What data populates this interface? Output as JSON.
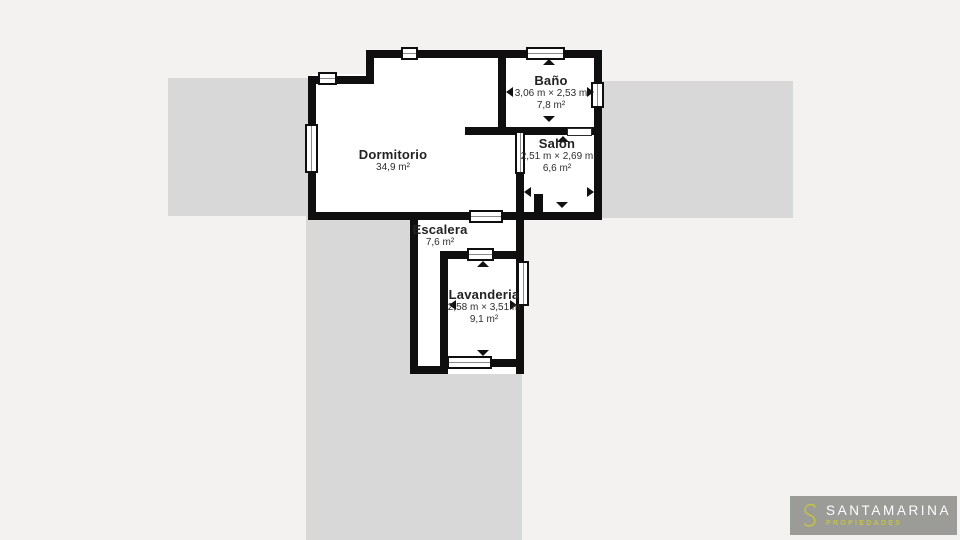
{
  "rooms": {
    "dormitorio": {
      "name": "Dormitorio",
      "area": "34,9 m²"
    },
    "bano": {
      "name": "Baño",
      "dims": "3,06 m × 2,53 m",
      "area": "7,8 m²"
    },
    "salon": {
      "name": "Salón",
      "dims": "2,51 m × 2,69 m",
      "area": "6,6 m²"
    },
    "escalera": {
      "name": "Escalera",
      "area": "7,6 m²"
    },
    "lavanderia": {
      "name": "Lavanderia",
      "dims": "2,58 m × 3,51 m",
      "area": "9,1 m²"
    }
  },
  "logo": {
    "monogram": "S",
    "brand": "SANTAMARINA",
    "tagline": "PROPIEDADES"
  },
  "colors": {
    "background": "#f3f2f0",
    "shadow_block": "#d8d8d8",
    "wall": "#0f0f0f",
    "room_fill": "#ffffff",
    "logo_box": "#9b9b98",
    "logo_accent": "#c3c43e",
    "logo_text": "#ffffff"
  }
}
